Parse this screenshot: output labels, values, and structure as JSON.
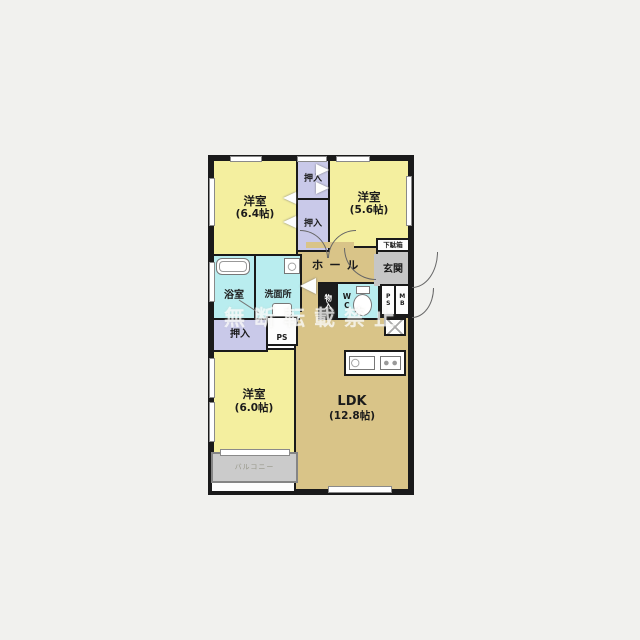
{
  "colors": {
    "bedroom_fill": "#f4ef9f",
    "closet_fill": "#c9c9e9",
    "wet_area_fill": "#b9edef",
    "wood_floor_fill": "#d9c488",
    "entrance_fill": "#c6c6c6",
    "balcony_fill": "#cbcbcb",
    "wall": "#1a1a1a",
    "watermark": "rgba(255,255,255,0.72)"
  },
  "rooms": {
    "bedroom1": {
      "label": "洋室",
      "size": "(6.4帖)"
    },
    "bedroom2": {
      "label": "洋室",
      "size": "(5.6帖)"
    },
    "bedroom3": {
      "label": "洋室",
      "size": "(6.0帖)"
    },
    "ldk": {
      "label": "LDK",
      "size": "(12.8帖)"
    },
    "hall": {
      "label": "ホール"
    },
    "entrance": {
      "label": "玄関"
    },
    "shoe_cabinet": {
      "label": "下駄箱"
    },
    "bath": {
      "label": "浴室"
    },
    "washroom": {
      "label": "洗面所"
    },
    "wc": {
      "label": "WC"
    },
    "storage": {
      "label": "物入"
    },
    "closet_upper": {
      "label": "押入"
    },
    "closet_middle": {
      "label": "押入"
    },
    "closet_west": {
      "label": "押入"
    },
    "pipe_space_center": {
      "label": "PS"
    },
    "pipe_space_entrance": {
      "label": "PS"
    },
    "meter_box": {
      "label": "MB"
    },
    "balcony": {
      "label": "バルコニー"
    }
  },
  "watermark": {
    "text": "無断転載禁止"
  }
}
